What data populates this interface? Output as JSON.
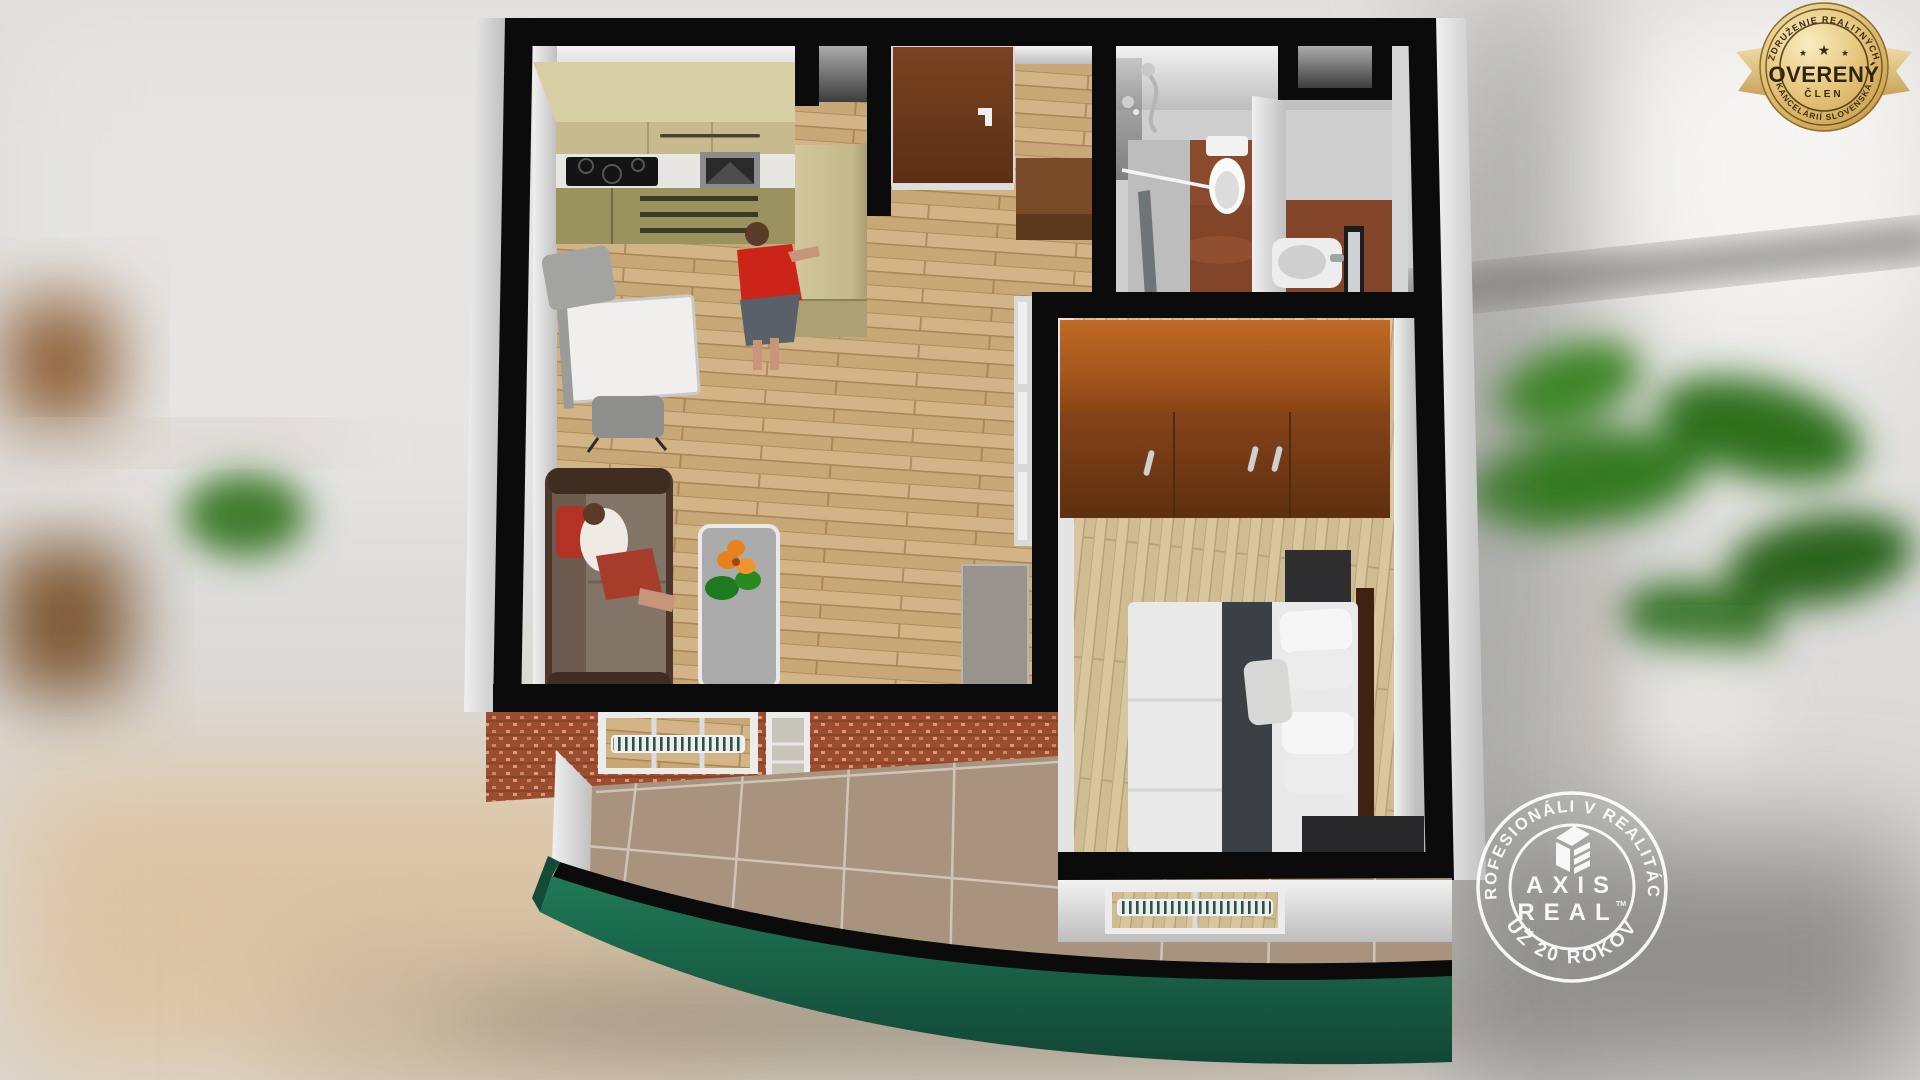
{
  "badge": {
    "arc_top": "ZDRUŽENIE REALITNÝCH",
    "arc_bottom": "KANCELÁRIÍ SLOVENSKA",
    "star": "★",
    "title": "OVERENÝ",
    "subtitle": "ČLEN"
  },
  "watermark": {
    "arc_top": "PROFESIONÁLI V REALITÁCH",
    "arc_bottom": "UŽ 20 ROKOV",
    "brand_top": "AXIS",
    "brand_bottom": "REAL",
    "trademark": "TM"
  },
  "palette": {
    "wall_black": "#0b0b0b",
    "wall_face_light": "#ececec",
    "wood_floor": "#c9a877",
    "bedroom_floor": "#d8c69e",
    "bathroom_floor": "#83452a",
    "balcony_tile": "#a8947e",
    "brick": "#9c4c2f",
    "parapet_green": "#17604650",
    "parapet_green_main": "#1b6148",
    "kitchen_cabinet_upper": "#d6cba0",
    "kitchen_cabinet_lower": "#98915f",
    "wardrobe_brown": "#7c3a10",
    "entry_door_brown": "#6e3a1c",
    "sofa_brown": "#503829",
    "badge_gold": "#d9b568",
    "badge_text_dark": "#352812",
    "watermark_white": "#ffffff"
  }
}
